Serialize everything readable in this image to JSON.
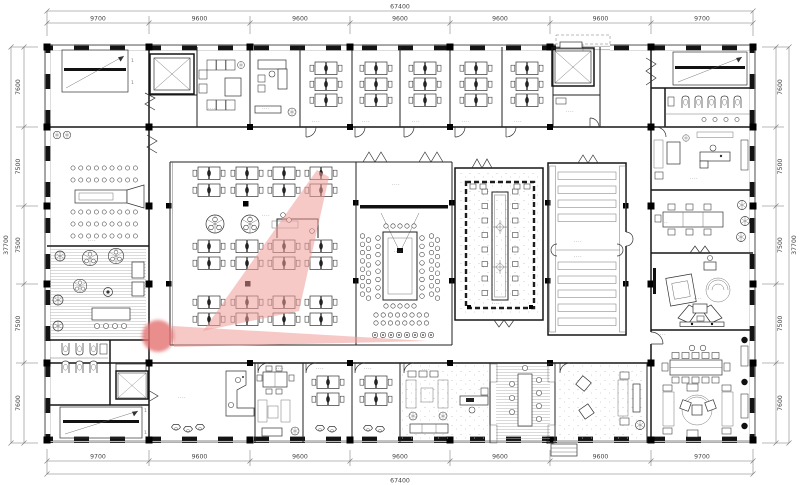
{
  "drawing": {
    "kind": "architectural-floor-plan",
    "description": "office building floor plan with central open office, conference rooms, stairs, elevators and perimeter offices"
  },
  "dims": {
    "top": {
      "total": "67400",
      "segments": [
        "9700",
        "9600",
        "9600",
        "9600",
        "9600",
        "9600",
        "9700"
      ]
    },
    "bottom": {
      "total": "67400",
      "segments": [
        "9700",
        "9600",
        "9600",
        "9600",
        "9600",
        "9600",
        "9700"
      ]
    },
    "left": {
      "total": "37700",
      "segments": [
        "7600",
        "7500",
        "7500",
        "7500",
        "7600"
      ]
    },
    "right": {
      "total": "37700",
      "segments": [
        "7600",
        "7500",
        "7500",
        "7500",
        "7600"
      ]
    }
  },
  "labels": {
    "room_placeholder": "····",
    "stair_mark": "1"
  },
  "annotation": {
    "shape": "arrow-highlight-with-click-marker",
    "fill": "#efa09c",
    "marker_fill": "#e4706f"
  },
  "colors": {
    "wall": "#141414",
    "line": "#333333",
    "dim_text": "#444444",
    "background": "#ffffff"
  }
}
